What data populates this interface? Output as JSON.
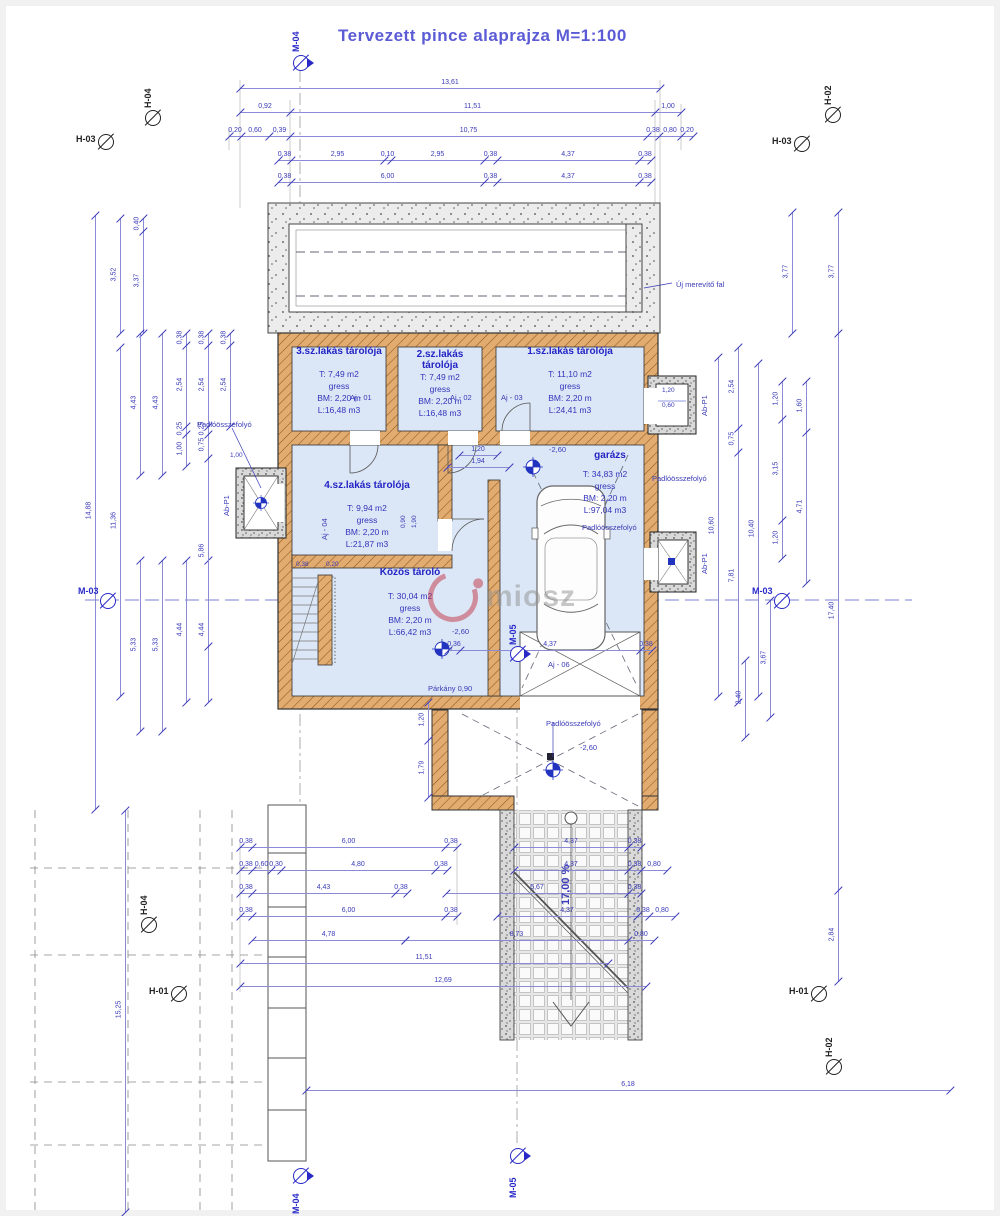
{
  "title": "Tervezett  pince alaprajza M=1:100",
  "watermark": "miosz",
  "colors": {
    "accent": "#3a3ab8",
    "title": "#5b5bd6",
    "wall": "#e0a96d",
    "room_fill": "#dbe7f6",
    "marker_blue": "#2929c8",
    "watermark_red": "#c23344"
  },
  "rooms": {
    "r3": {
      "name": "3.sz.lakás tárolója",
      "area": "T: 7,49 m2",
      "finish": "gress",
      "height": "BM: 2,20 m",
      "volume": "L:16,48 m3"
    },
    "r2": {
      "name": "2.sz.lakás tárolója",
      "area": "T: 7,49 m2",
      "finish": "gress",
      "height": "BM: 2,20 m",
      "volume": "L:16,48 m3"
    },
    "r1": {
      "name": "1.sz.lakás tárolója",
      "area": "T: 11,10 m2",
      "finish": "gress",
      "height": "BM: 2,20 m",
      "volume": "L:24,41 m3"
    },
    "r4": {
      "name": "4.sz.lakás tárolója",
      "area": "T: 9,94 m2",
      "finish": "gress",
      "height": "BM: 2,20 m",
      "volume": "L:21,87 m3"
    },
    "garage": {
      "name": "garázs",
      "area": "T: 34,83 m2",
      "finish": "gress",
      "height": "BM: 2,20 m",
      "volume": "L:97,04 m3"
    },
    "common": {
      "name": "Közös tároló",
      "area": "T: 30,04 m2",
      "finish": "gress",
      "height": "BM: 2,20 m",
      "volume": "L:66,42 m3"
    }
  },
  "free_labels": [
    {
      "t": "Új merevítő fal",
      "x": 676,
      "y": 280
    },
    {
      "t": "Padlóösszefolyó",
      "x": 197,
      "y": 420
    },
    {
      "t": "Padlóösszefolyó",
      "x": 582,
      "y": 523
    },
    {
      "t": "Padlóösszefolyó",
      "x": 652,
      "y": 474
    },
    {
      "t": "Padlóösszefolyó",
      "x": 546,
      "y": 719
    },
    {
      "t": "Párkány 0,90",
      "x": 428,
      "y": 684
    },
    {
      "t": "-2,60",
      "x": 549,
      "y": 445
    },
    {
      "t": "-2,60",
      "x": 452,
      "y": 627
    },
    {
      "t": "-2,60",
      "x": 580,
      "y": 743
    },
    {
      "t": "17,00 %",
      "x": 560,
      "y": 905,
      "r": 1,
      "s": "b"
    },
    {
      "t": "Aj - 01",
      "x": 350,
      "y": 393
    },
    {
      "t": "Aj - 02",
      "x": 450,
      "y": 393
    },
    {
      "t": "Aj - 03",
      "x": 501,
      "y": 393
    },
    {
      "t": "Aj - 06",
      "x": 548,
      "y": 660
    },
    {
      "t": "Aj - 04",
      "x": 320,
      "y": 540,
      "r": 1
    },
    {
      "t": "Ab-P1",
      "x": 222,
      "y": 516,
      "r": 1
    },
    {
      "t": "Ab-P1",
      "x": 700,
      "y": 416,
      "r": 1
    },
    {
      "t": "Ab-P1",
      "x": 700,
      "y": 574,
      "r": 1
    },
    {
      "t": "1,20",
      "x": 662,
      "y": 387,
      "s": "t"
    },
    {
      "t": "0,60",
      "x": 662,
      "y": 402,
      "s": "t"
    },
    {
      "t": "1,00",
      "x": 230,
      "y": 452,
      "s": "t"
    },
    {
      "t": "0,38",
      "x": 296,
      "y": 561,
      "s": "t"
    },
    {
      "t": "0,20",
      "x": 326,
      "y": 561,
      "s": "t"
    },
    {
      "t": "0,90",
      "x": 400,
      "y": 528,
      "r": 1,
      "s": "t"
    },
    {
      "t": "1,90",
      "x": 411,
      "y": 528,
      "r": 1,
      "s": "t"
    }
  ],
  "markers": [
    {
      "t": "M-04",
      "x": 300,
      "y": 62,
      "c": "b",
      "tri": 1,
      "lx": 291,
      "ly": 52,
      "lr": 1
    },
    {
      "t": "H-04",
      "x": 152,
      "y": 117,
      "c": "k",
      "lx": 143,
      "ly": 108,
      "lr": 1
    },
    {
      "t": "H-03",
      "x": 105,
      "y": 141,
      "c": "k",
      "lx": 76,
      "ly": 134,
      "lr": 0
    },
    {
      "t": "H-02",
      "x": 832,
      "y": 114,
      "c": "k",
      "lx": 823,
      "ly": 105,
      "lr": 1
    },
    {
      "t": "H-03",
      "x": 801,
      "y": 143,
      "c": "k",
      "lx": 772,
      "ly": 136,
      "lr": 0
    },
    {
      "t": "M-03",
      "x": 107,
      "y": 600,
      "c": "b",
      "lx": 78,
      "ly": 586,
      "lr": 0
    },
    {
      "t": "M-03",
      "x": 781,
      "y": 600,
      "c": "b",
      "lx": 752,
      "ly": 586,
      "lr": 0
    },
    {
      "t": "M-05",
      "x": 517,
      "y": 653,
      "c": "b",
      "tri": 1,
      "lx": 508,
      "ly": 645,
      "lr": 1
    },
    {
      "t": "H-04",
      "x": 148,
      "y": 924,
      "c": "k",
      "lx": 139,
      "ly": 915,
      "lr": 1
    },
    {
      "t": "H-01",
      "x": 178,
      "y": 993,
      "c": "k",
      "lx": 149,
      "ly": 986,
      "lr": 0
    },
    {
      "t": "H-01",
      "x": 818,
      "y": 993,
      "c": "k",
      "lx": 789,
      "ly": 986,
      "lr": 0
    },
    {
      "t": "H-02",
      "x": 833,
      "y": 1066,
      "c": "k",
      "lx": 824,
      "ly": 1057,
      "lr": 1
    },
    {
      "t": "M-05",
      "x": 517,
      "y": 1155,
      "c": "b",
      "tri": 1,
      "lx": 508,
      "ly": 1198,
      "lr": 1
    },
    {
      "t": "M-04",
      "x": 300,
      "y": 1175,
      "c": "b",
      "tri": 1,
      "lx": 291,
      "ly": 1214,
      "lr": 1
    }
  ],
  "dim_chains": [
    {
      "o": "h",
      "y": 88,
      "xs": [
        240,
        660
      ],
      "ls": [
        "13,61"
      ]
    },
    {
      "o": "h",
      "y": 112,
      "xs": [
        240,
        290,
        655,
        681
      ],
      "ls": [
        "0,92",
        "11,51",
        "1,00"
      ]
    },
    {
      "o": "h",
      "y": 136,
      "xs": [
        229,
        241,
        269,
        290,
        647,
        659,
        681,
        693
      ],
      "ls": [
        "0,20",
        "0,60",
        "0,39",
        "10,75",
        "0,38",
        "0,80",
        "0,20"
      ]
    },
    {
      "o": "h",
      "y": 160,
      "xs": [
        278,
        291,
        384,
        391,
        484,
        497,
        639,
        651
      ],
      "ls": [
        "0,38",
        "2,95",
        "0,10",
        "2,95",
        "0,38",
        "4,37",
        "0,38"
      ]
    },
    {
      "o": "h",
      "y": 182,
      "xs": [
        278,
        291,
        484,
        497,
        639,
        651
      ],
      "ls": [
        "0,38",
        "6,00",
        "0,38",
        "4,37",
        "0,38"
      ]
    },
    {
      "o": "h",
      "y": 455,
      "xs": [
        459,
        497
      ],
      "ls": [
        "1,20"
      ]
    },
    {
      "o": "h",
      "y": 467,
      "xs": [
        447,
        509
      ],
      "ls": [
        "1,94"
      ]
    },
    {
      "o": "h",
      "y": 650,
      "xs": [
        448,
        460,
        640,
        652
      ],
      "ls": [
        "0,36",
        "4,37",
        "0,38"
      ]
    },
    {
      "o": "h",
      "y": 847,
      "xs": [
        240,
        252,
        445,
        457
      ],
      "ls": [
        "0,38",
        "6,00",
        "0,38"
      ]
    },
    {
      "o": "h",
      "y": 847,
      "xs": [
        514,
        628,
        641
      ],
      "ls": [
        "4,37",
        "0,38"
      ]
    },
    {
      "o": "h",
      "y": 870,
      "xs": [
        240,
        252,
        271,
        281,
        435,
        447
      ],
      "ls": [
        "0,38",
        "0,60",
        "0,30",
        "4,80",
        "0,38"
      ]
    },
    {
      "o": "h",
      "y": 870,
      "xs": [
        514,
        628,
        641,
        667
      ],
      "ls": [
        "4,37",
        "0,38",
        "0,80"
      ]
    },
    {
      "o": "h",
      "y": 893,
      "xs": [
        240,
        252,
        395,
        407
      ],
      "ls": [
        "0,38",
        "4,43",
        "0,38"
      ]
    },
    {
      "o": "h",
      "y": 893,
      "xs": [
        446,
        628,
        641
      ],
      "ls": [
        "5,67",
        "0,38"
      ]
    },
    {
      "o": "h",
      "y": 916,
      "xs": [
        240,
        252,
        445,
        457
      ],
      "ls": [
        "0,38",
        "6,00",
        "0,38"
      ]
    },
    {
      "o": "h",
      "y": 916,
      "xs": [
        497,
        637,
        649,
        675
      ],
      "ls": [
        "4,37",
        "0,38",
        "0,80"
      ]
    },
    {
      "o": "h",
      "y": 940,
      "xs": [
        252,
        405
      ],
      "ls": [
        "4,78"
      ]
    },
    {
      "o": "h",
      "y": 940,
      "xs": [
        405,
        628,
        654
      ],
      "ls": [
        "8,73",
        "0,80"
      ]
    },
    {
      "o": "h",
      "y": 963,
      "xs": [
        240,
        608
      ],
      "ls": [
        "11,51"
      ]
    },
    {
      "o": "h",
      "y": 986,
      "xs": [
        240,
        646
      ],
      "ls": [
        "12,69"
      ]
    },
    {
      "o": "h",
      "y": 1090,
      "xs": [
        306,
        950
      ],
      "ls": [
        "6,18"
      ]
    },
    {
      "o": "v",
      "x": 120,
      "ys": [
        218,
        333
      ],
      "ls": [
        "3,52"
      ]
    },
    {
      "o": "v",
      "x": 143,
      "ys": [
        218,
        231,
        333
      ],
      "ls": [
        "0,40",
        "3,37"
      ]
    },
    {
      "o": "v",
      "x": 95,
      "ys": [
        215,
        809
      ],
      "ls": [
        "14,88"
      ]
    },
    {
      "o": "v",
      "x": 120,
      "ys": [
        347,
        696
      ],
      "ls": [
        "11,36"
      ]
    },
    {
      "o": "v",
      "x": 140,
      "ys": [
        333,
        475
      ],
      "ls": [
        "4,43"
      ]
    },
    {
      "o": "v",
      "x": 162,
      "ys": [
        333,
        475
      ],
      "ls": [
        "4,43"
      ]
    },
    {
      "o": "v",
      "x": 140,
      "ys": [
        560,
        731
      ],
      "ls": [
        "5,33"
      ]
    },
    {
      "o": "v",
      "x": 162,
      "ys": [
        560,
        731
      ],
      "ls": [
        "5,33"
      ]
    },
    {
      "o": "v",
      "x": 186,
      "ys": [
        560,
        702
      ],
      "ls": [
        "4,44"
      ]
    },
    {
      "o": "v",
      "x": 208,
      "ys": [
        560,
        702
      ],
      "ls": [
        "4,44"
      ]
    },
    {
      "o": "v",
      "x": 186,
      "ys": [
        333,
        345,
        426,
        434,
        466
      ],
      "ls": [
        "0,38",
        "2,54",
        "0,25",
        "1,00"
      ]
    },
    {
      "o": "v",
      "x": 208,
      "ys": [
        333,
        345,
        426,
        434,
        458,
        646
      ],
      "ls": [
        "0,38",
        "2,54",
        "0,25",
        "0,75",
        "5,86"
      ]
    },
    {
      "o": "v",
      "x": 230,
      "ys": [
        333,
        345,
        426
      ],
      "ls": [
        "0,38",
        "2,54"
      ]
    },
    {
      "o": "v",
      "x": 125,
      "ys": [
        810,
        1212
      ],
      "ls": [
        "15,25"
      ]
    },
    {
      "o": "v",
      "x": 718,
      "ys": [
        357,
        696
      ],
      "ls": [
        "10,60"
      ]
    },
    {
      "o": "v",
      "x": 738,
      "ys": [
        347,
        428,
        452,
        702
      ],
      "ls": [
        "2,54",
        "0,75",
        "7,81"
      ]
    },
    {
      "o": "v",
      "x": 758,
      "ys": [
        363,
        696
      ],
      "ls": [
        "10,40"
      ]
    },
    {
      "o": "v",
      "x": 782,
      "ys": [
        381,
        419,
        520,
        558
      ],
      "ls": [
        "1,20",
        "3,15",
        "1,20"
      ]
    },
    {
      "o": "v",
      "x": 806,
      "ys": [
        381,
        432,
        583
      ],
      "ls": [
        "1,60",
        "4,71"
      ]
    },
    {
      "o": "v",
      "x": 792,
      "ys": [
        212,
        333
      ],
      "ls": [
        "3,77"
      ]
    },
    {
      "o": "v",
      "x": 838,
      "ys": [
        212,
        333,
        890,
        981
      ],
      "ls": [
        "3,77",
        "17,40",
        "2,84"
      ]
    },
    {
      "o": "v",
      "x": 770,
      "ys": [
        600,
        717
      ],
      "ls": [
        "3,67"
      ]
    },
    {
      "o": "v",
      "x": 745,
      "ys": [
        660,
        737
      ],
      "ls": [
        "2,40"
      ]
    },
    {
      "o": "v",
      "x": 428,
      "ys": [
        702,
        740,
        797
      ],
      "ls": [
        "1,20",
        "1,79"
      ]
    }
  ]
}
